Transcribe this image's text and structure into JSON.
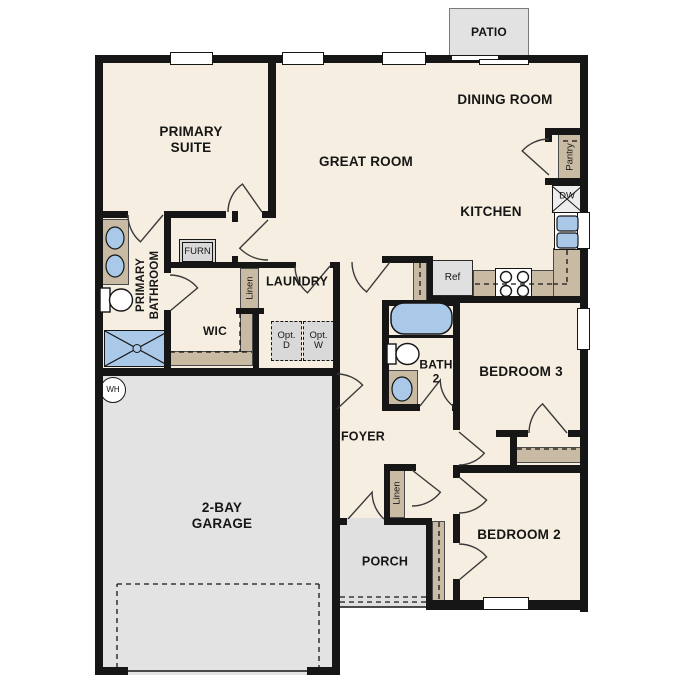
{
  "colors": {
    "floor": "#f6efe1",
    "garage_floor": "#e3e3e3",
    "porch_floor": "#e0e0e0",
    "patio_floor": "#e2e2e2",
    "casework_tan": "#c9baa3",
    "fixture_blue": "#aac9e9",
    "wall_black": "#161616"
  },
  "rooms": {
    "patio": "PATIO",
    "dining_room": "DINING ROOM",
    "great_room": "GREAT ROOM",
    "kitchen": "KITCHEN",
    "primary_suite": "PRIMARY\nSUITE",
    "primary_bathroom": "PRIMARY\nBATHROOM",
    "wic": "WIC",
    "laundry": "LAUNDRY",
    "foyer": "FOYER",
    "porch": "PORCH",
    "bath2": "BATH\n2",
    "bedroom3": "BEDROOM 3",
    "bedroom2": "BEDROOM 2",
    "garage": "2-BAY\nGARAGE"
  },
  "closets": {
    "pantry": "Pantry",
    "linen_hall": "Linen",
    "linen_foyer": "Linen"
  },
  "appliances": {
    "dishwasher": "DW",
    "refrigerator": "Ref",
    "furnace": "FURN",
    "water_heater": "WH",
    "optional_dryer": "Opt.\nD",
    "optional_washer": "Opt.\nW"
  }
}
